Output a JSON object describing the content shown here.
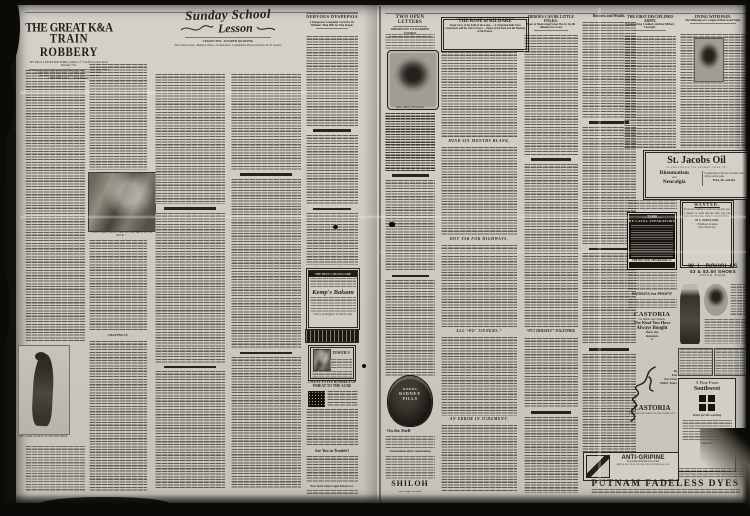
{
  "colors": {
    "paper": "#cdcbc2",
    "ink": "#24221c",
    "scan_background": "#0d0c0a"
  },
  "left_page": {
    "kanda": {
      "title1": "THE GREAT K&A",
      "title2": "TRAIN ROBBERY",
      "byline": "BY PAUL LEICESTER FORD, Author of “The Honorable Peter Stirling,” Etc.",
      "copyright": "(Copyright, by Dodd, Mead & Company. All rights reserved.)",
      "chapter_continued": "CHAPTER XII.—(Continued.)",
      "chapter_new": "CHAPTER XV.",
      "caption1": "“I GOT SOMETHING COLD ON THE BACK OF MY NECK.”",
      "caption2": "SHE CAME SLOWLY DOWN THE PATH."
    },
    "lesson": {
      "title1": "Sunday School",
      "title2": "Lesson",
      "subhead1": "LESSON TEN—FOURTH QUARTER.",
      "subhead2": "Text of the Lesson—Memory Verses—Golden Text—Commentary Prepared by Rev. D. M. Stearns."
    },
    "dyspepsia": {
      "headline": "NERVOUS DYSPEPSIA",
      "subhead": "A Dangerous Complaint Cured by Dr. Williams' Pink Pills for Pale People."
    },
    "kemps": {
      "top": "THE BEST COUGH CURE",
      "name": "Kemp's Balsam",
      "bottom": "Sold by all druggists. 25 and 50 cents."
    },
    "towers": {
      "name": "TOWER'S"
    },
    "wheat": {
      "headline": "TWENTY-FIVE BUSHELS OF WHEAT TO THE ACRE"
    },
    "trouble": {
      "headline": "Are You in Trouble?"
    },
    "legal": {
      "line": "New York State Legal Advice Co."
    }
  },
  "right_page": {
    "open_letters": {
      "headline": "TWO OPEN LETTERS",
      "subhead": "IMPORTANT TO MARRIED WOMEN",
      "caption": "Mrs. Mary Dimmick"
    },
    "rose": {
      "headline": "“THE ROSE of KILDARE”",
      "subtitle": "Tragic Story of the Exile of the Lakes — A Cherished Relic from Connemara and the Vale of Avoca — Home of the Bard and the Meeting of the Waters."
    },
    "col2_heads": {
      "mind": "MIND SIX MONTHS BLANK.",
      "tar": "HOT TAR FOR HIGHWAYS.",
      "jinners": "ALL “PO’ JINNERS.”",
      "error": "AN ERROR IN JUDGMENT."
    },
    "heroes": {
      "headline": "HEROES CAN BE LITTLE FOLKS.",
      "subhead": "Heart of Black Angel Street Has Its Up-lift Influence for Good."
    },
    "together_head": "“PUT HIMSELF” TOGETHER.",
    "wealth_head": "Business and Wealth.",
    "army": {
      "headline": "THE FIRST DISCIPLINED ARMY.",
      "subhead": "Egyptian King Credited with Best Military Foresight."
    },
    "pain": {
      "headline": "DYING WITH PAIN.",
      "subhead": "The Sufferings of a Couple of Hours Each Night."
    },
    "stjacobs": {
      "pre": "THE EXTERNAL USE OF",
      "name": "St. Jacobs Oil",
      "mid": "IS PROVEN BY ITS PROMPT CURE OF",
      "ail1": "Rheumatism",
      "conj": "and",
      "ail2": "Neuralgia",
      "side": "It penetrates to the seat of torture and drives out the pain.",
      "price": "Price, 25c. and 50c."
    },
    "delaval": {
      "count": "— 35,000 —",
      "name": "DE LAVAL SEPARATORS",
      "footer": "THE DE LAVAL SEPARATOR CO."
    },
    "wanted": {
      "head": "WANTED.",
      "body": "If you are willing to work we can give you a chance to work and get rich; you can earn a fair income, home or abroad. Write",
      "name": "H. L. HOWLAND,",
      "addr1": "1 Madison Avenue,",
      "addr2": "New York City."
    },
    "douglas": {
      "name": "W. L. DOUGLAS",
      "product": "$3 & $3.50 SHOES",
      "note": "UNION MADE"
    },
    "patents_head": "PATENTS for PROFIT",
    "castoria": {
      "name": "CASTORIA",
      "infants": "For Infants and Children.",
      "kind1": "The Kind You Have",
      "kind2": "Always Bought",
      "bears": "Bears the",
      "signature_word": "Signature",
      "of": "of",
      "in": "In",
      "use": "Use",
      "for_over": "For Over",
      "years": "Thirty Years",
      "name2": "CASTORIA",
      "footer": "THE CENTAUR COMPANY, NEW YORK CITY."
    },
    "dodds": {
      "l1": "DODDS",
      "l2": "KIDNEY",
      "l3": "PILLS"
    },
    "shelf_head": "On the Shelf",
    "generation_head": "Generation after Generation",
    "shiloh": {
      "name": "SHILOH",
      "tag": "cures coughs and colds."
    },
    "antigripine": {
      "name": "ANTI-GRIPINE",
      "sub1": "IS GUARANTEED TO CURE",
      "sub2": "GRIP, BAD COLD, HEADACHE AND NEURALGIA."
    },
    "finefarm": {
      "line1": "A Fine Farm",
      "line2": "Southwest",
      "slogan": "Yours for the working",
      "railroad": "Santa Fe"
    },
    "putnam": {
      "name": "PUTNAM FADELESS DYES"
    }
  }
}
